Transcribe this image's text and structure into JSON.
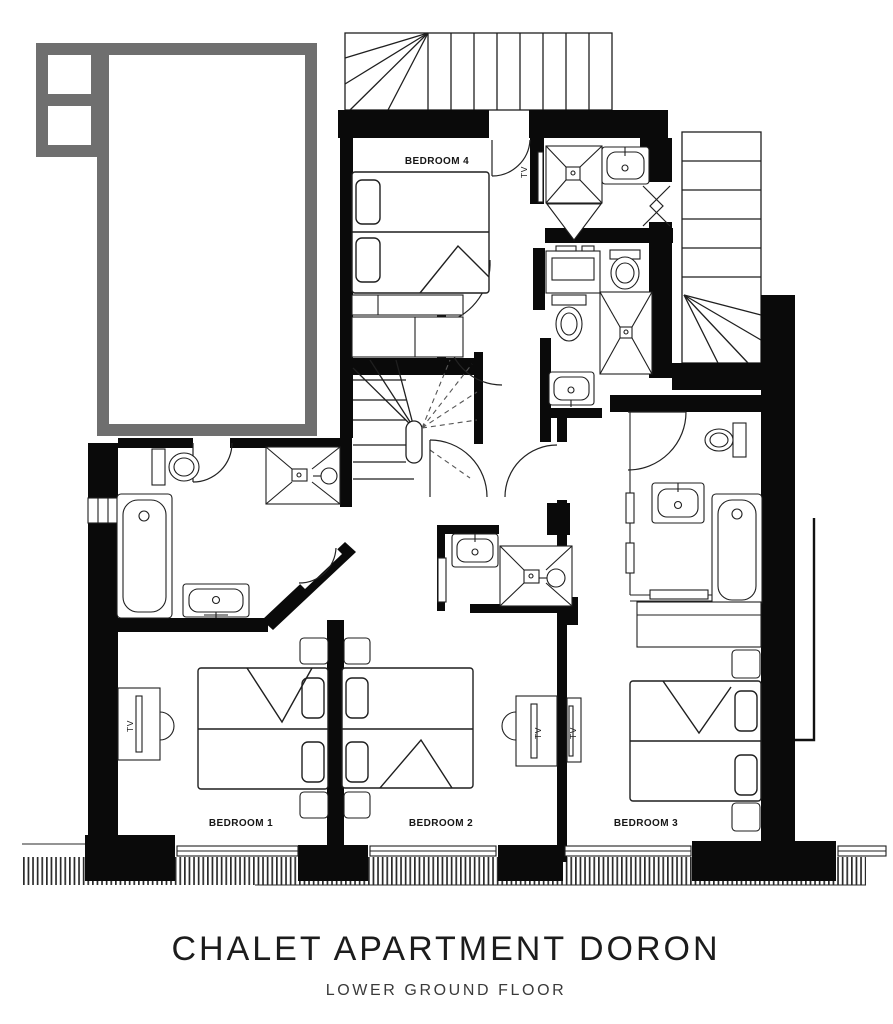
{
  "plan": {
    "rooms": {
      "bedroom1": {
        "label": "BEDROOM 1"
      },
      "bedroom2": {
        "label": "BEDROOM 2"
      },
      "bedroom3": {
        "label": "BEDROOM 3"
      },
      "bedroom4": {
        "label": "BEDROOM 4"
      }
    },
    "tv_labels": {
      "bedroom1": "TV",
      "bedroom2": "TV",
      "bedroom3": "TV",
      "bedroom4": "TV"
    },
    "colors": {
      "walls": "#0a0a0a",
      "upper_floor_outline": "#6f6f6f",
      "linework": "#1f1f1f",
      "background": "#ffffff"
    },
    "fixture_icons": [
      "double-bed-icon",
      "bathtub-icon",
      "shower-icon",
      "washbasin-icon",
      "toilet-icon",
      "staircase-icon",
      "tv-icon",
      "wardrobe-icon",
      "window-icon",
      "door-swing-icon",
      "deck-hatch-icon"
    ]
  },
  "footer": {
    "title": "CHALET APARTMENT DORON",
    "subtitle": "LOWER GROUND FLOOR"
  }
}
